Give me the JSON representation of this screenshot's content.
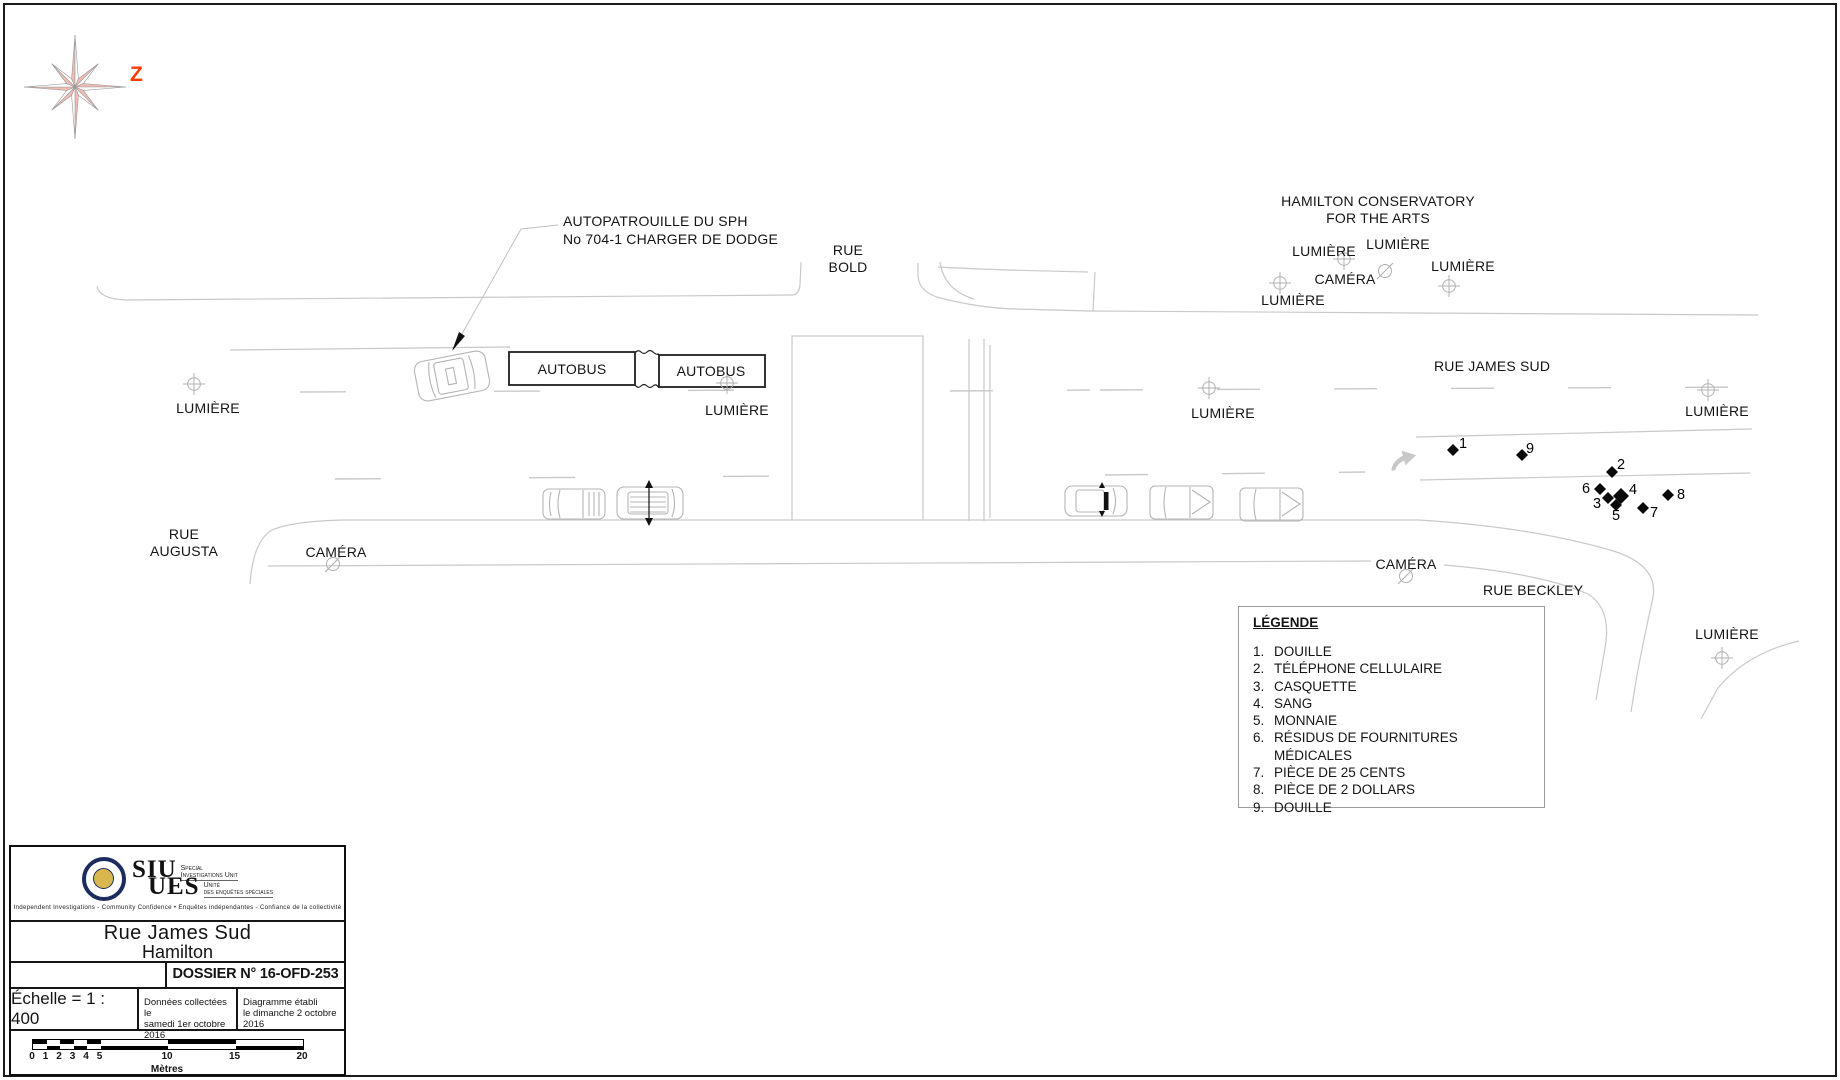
{
  "colors": {
    "page_bg": "#ffffff",
    "road_line_gray": "#c9c9c9",
    "vehicle_gray": "#b4b4b4",
    "compass_pink": "#f3bdb5",
    "north_arrow_red": "#ff3b00",
    "ink": "#141414"
  },
  "compass": {
    "north_label": "Z"
  },
  "callouts": {
    "patrol_line1": "AUTOPATROUILLE DU SPH",
    "patrol_line2": "No 704-1 CHARGER DE DODGE",
    "conservatory_line1": "HAMILTON CONSERVATORY",
    "conservatory_line2": "FOR THE ARTS"
  },
  "streets": {
    "bold_line1": "RUE",
    "bold_line2": "BOLD",
    "james_sud": "RUE JAMES SUD",
    "augusta_line1": "RUE",
    "augusta_line2": "AUGUSTA",
    "beckley": "RUE BECKLEY"
  },
  "fixtures": {
    "light_label": "LUMIÈRE",
    "camera_label": "CAMÉRA",
    "bus_label": "AUTOBUS"
  },
  "evidence_markers": [
    "1",
    "2",
    "3",
    "4",
    "5",
    "6",
    "7",
    "8",
    "9"
  ],
  "legend": {
    "title": "LÉGENDE",
    "items": [
      {
        "num": "1.",
        "label": "DOUILLE"
      },
      {
        "num": "2.",
        "label": "TÉLÉPHONE CELLULAIRE"
      },
      {
        "num": "3.",
        "label": "CASQUETTE"
      },
      {
        "num": "4.",
        "label": "SANG"
      },
      {
        "num": "5.",
        "label": "MONNAIE"
      },
      {
        "num": "6.",
        "label": "RÉSIDUS DE FOURNITURES MÉDICALES"
      },
      {
        "num": "7.",
        "label": "PIÈCE DE 25 CENTS"
      },
      {
        "num": "8.",
        "label": "PIÈCE DE 2 DOLLARS"
      },
      {
        "num": "9.",
        "label": "DOUILLE"
      }
    ]
  },
  "title_block": {
    "logo": {
      "siu": "SIU",
      "siu_sub_line1": "Special",
      "siu_sub_line2": "Investigations Unit",
      "ues": "UES",
      "ues_sub_line1": "Unité",
      "ues_sub_line2": "des enquêtes spéciales",
      "tagline": "Independent Investigations - Community Confidence • Enquêtes indépendantes - Confiance de la collectivité"
    },
    "location_line1": "Rue James Sud",
    "location_line2": "Hamilton",
    "dossier": "DOSSIER N° 16-OFD-253",
    "scale_text": "Échelle =  1 : 400",
    "collected_line1": "Données collectées le",
    "collected_line2": "samedi 1er octobre 2016",
    "established_line1": "Diagramme établi",
    "established_line2": "le dimanche 2 octobre 2016",
    "scalebar": {
      "ticks": [
        "0",
        "1",
        "2",
        "3",
        "4",
        "5",
        "10",
        "15",
        "20"
      ],
      "unit": "Mètres"
    }
  }
}
